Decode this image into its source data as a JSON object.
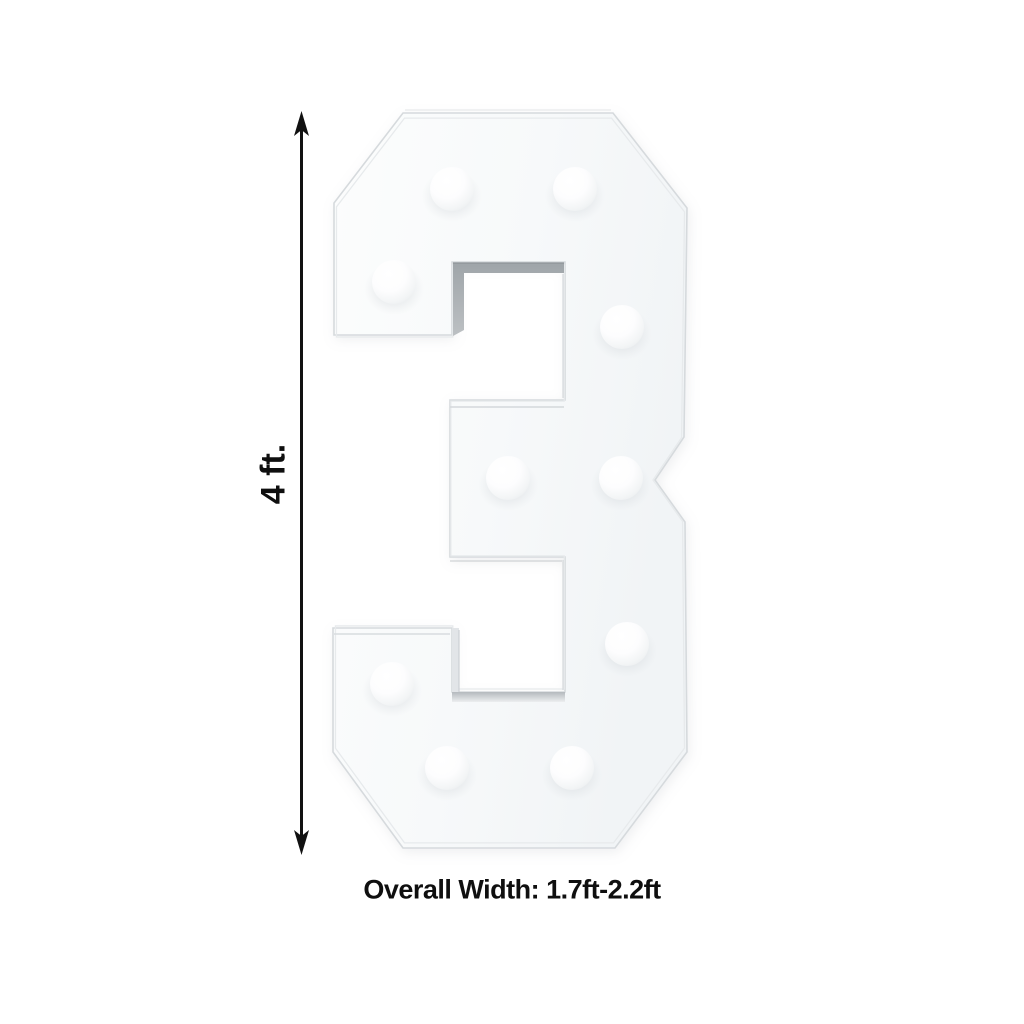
{
  "diagram": {
    "numeral": "3",
    "bulb_count": 10,
    "height_label": "4 ft.",
    "width_label": "Overall Width: 1.7ft-2.2ft",
    "colors": {
      "background": "#ffffff",
      "annotation": "#111111",
      "numeral_face": "#f7f9fa",
      "numeral_edge": "#d6dadd",
      "counter_wall_shadow": "#a9aeb2",
      "bulb_highlight": "#ffffff",
      "bulb_shadow": "#c9ced2"
    }
  }
}
